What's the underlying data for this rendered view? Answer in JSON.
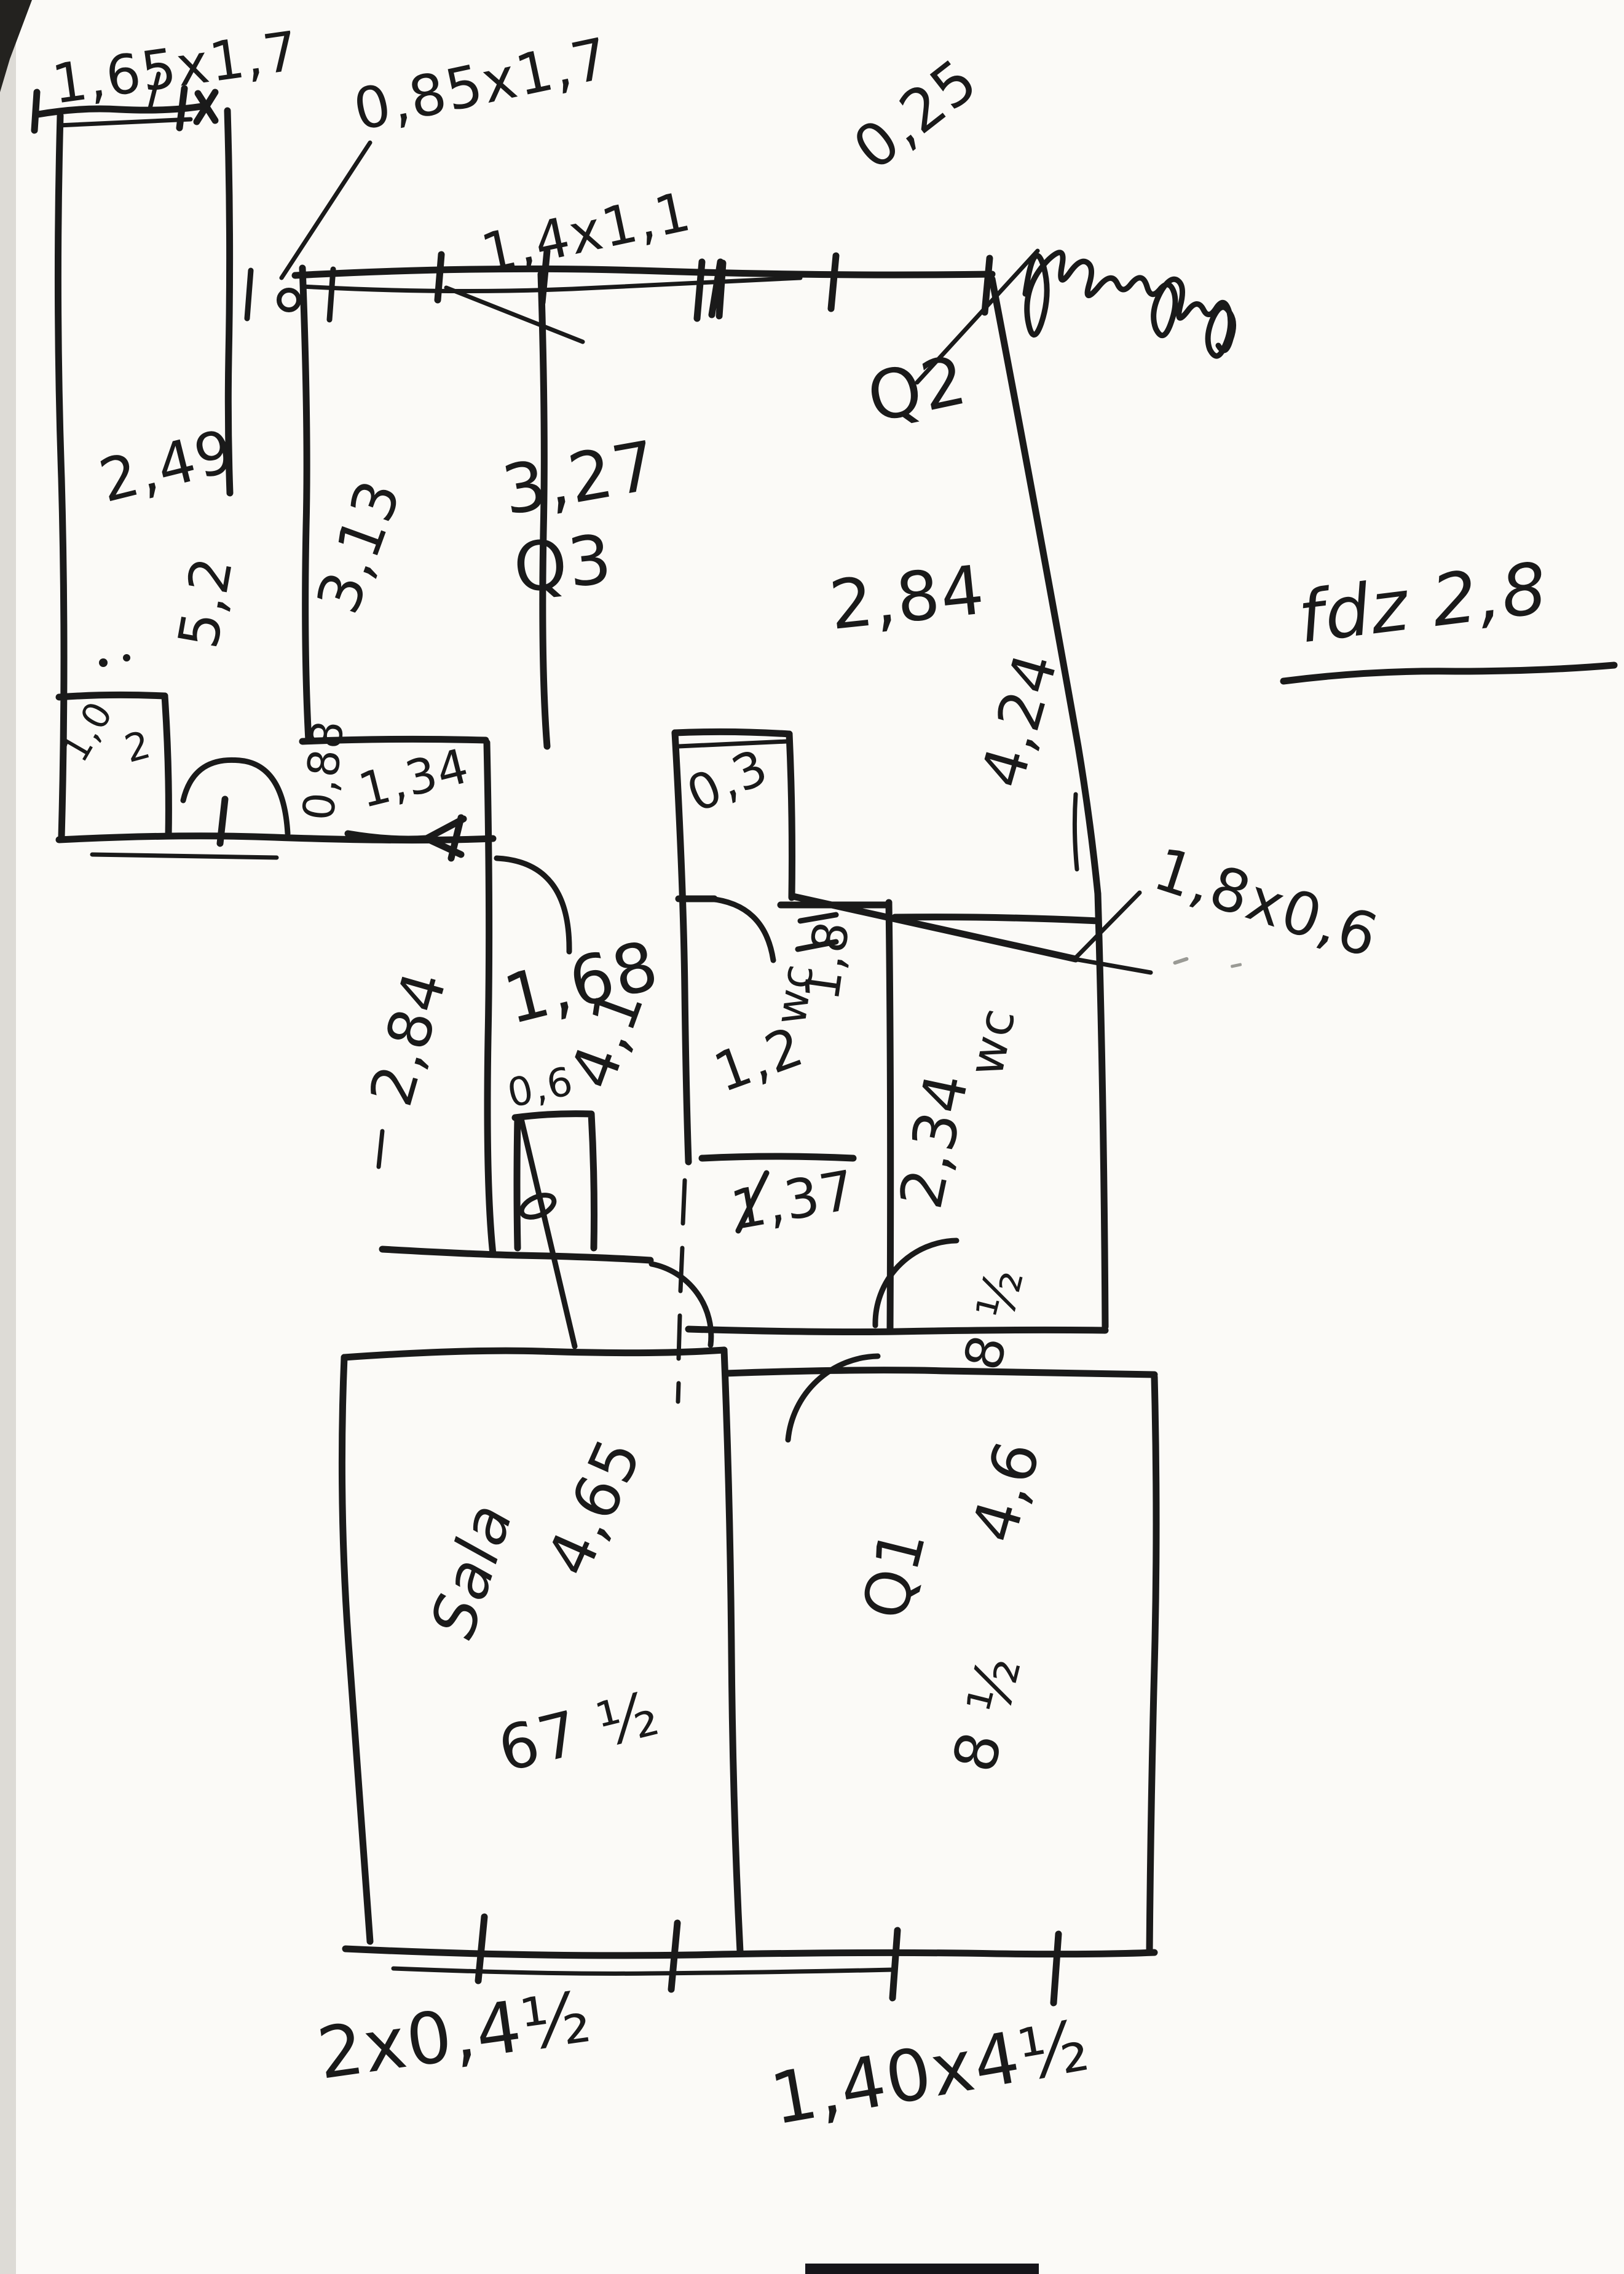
{
  "title": "Hand-drawn floor plan sketch (pen on paper)",
  "ink": "#1a1a1a",
  "paper": "#fbfaf7",
  "annotations": {
    "dim_window_left": "1,65x1,7",
    "dim_window_left2": "0,85x1,7",
    "dim_window_mid": "1,4x1,1",
    "dim_wall_thickness": "0,25",
    "scribble_note": "illegible-cursive-scribble",
    "note_right": "fdz 2,8",
    "dim_balcony_door": "1,8x0,6",
    "dim_bottom_left": "2x0,4½",
    "dim_bottom_right": "1,40x4½"
  },
  "rooms": {
    "left": {
      "width": "2,49",
      "height": "5,2",
      "alcove_width": "1,0",
      "alcove_depth": "2",
      "passage": "0,88",
      "door": "1,34"
    },
    "q3": {
      "name": "Q3",
      "width": "3,27",
      "height": "3,13"
    },
    "q2": {
      "name": "Q2",
      "width": "2,84",
      "height": "4,24"
    },
    "corridor": {
      "width": "1,68",
      "length": "4,1",
      "side": "2,84",
      "shaft": "0,6",
      "gap": "0,3"
    },
    "wc_small": {
      "name": "wc",
      "height": "1,8",
      "width": "1,2",
      "below": "1,37"
    },
    "wc_large": {
      "name": "wc",
      "height": "2,34",
      "area": "8 ½"
    },
    "sala": {
      "name": "Sala",
      "width": "4,65",
      "bottom": "67 ½"
    },
    "q1": {
      "name": "Q1",
      "height": "4,6",
      "area": "8 ½"
    }
  }
}
